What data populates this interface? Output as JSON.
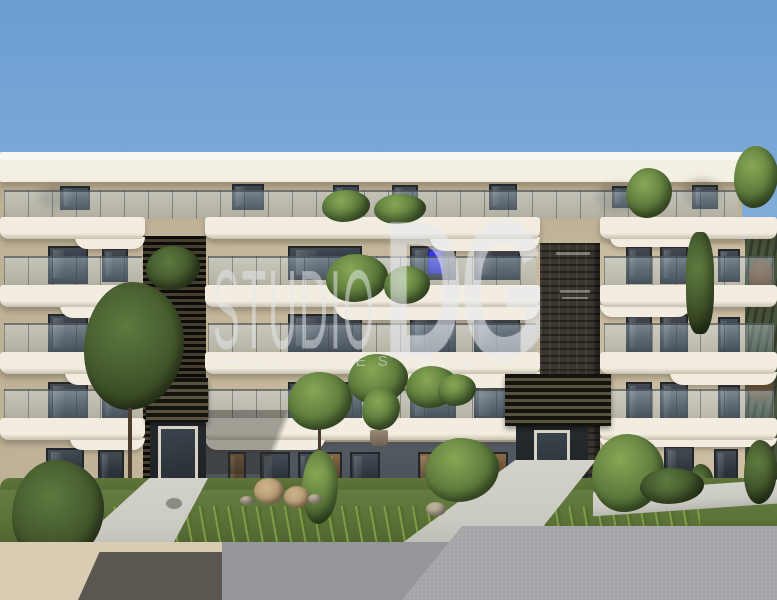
{
  "scene": {
    "type": "architectural-rendering",
    "subject": "Modern apartment building with curved white balconies, rooftop plants, vertical gardens and landscaped front yard"
  },
  "watermark": {
    "studio": "STUDIO",
    "monogram": "DG",
    "tagline": "REAL ESTATE"
  },
  "palette": {
    "sky_top": "#6B9ED1",
    "sky_bottom": "#AECBE5",
    "fascia": "#F4EFE3",
    "band": "#F2EDE0",
    "beige": "#C6B89D",
    "attic": "#B9AC92",
    "window_dark": "#2E343A",
    "ground_gray": "#4C525A",
    "lattice": "#2B2722",
    "brick": "#3A352E",
    "green_wall": "#47533B",
    "foliage": "#5C7A3C",
    "foliage_dark": "#3F5527",
    "grass": "#5C7338",
    "grass_dark": "#475C2D",
    "path": "#CBCAC3",
    "cream_wall": "#D9CCB2",
    "shadow_brown": "#514D45",
    "gray_wall": "#96979A",
    "gray_wall_light": "#A8A9AC",
    "accent_blue": "#2B2BD0",
    "watermark": "#E8EBF0"
  }
}
